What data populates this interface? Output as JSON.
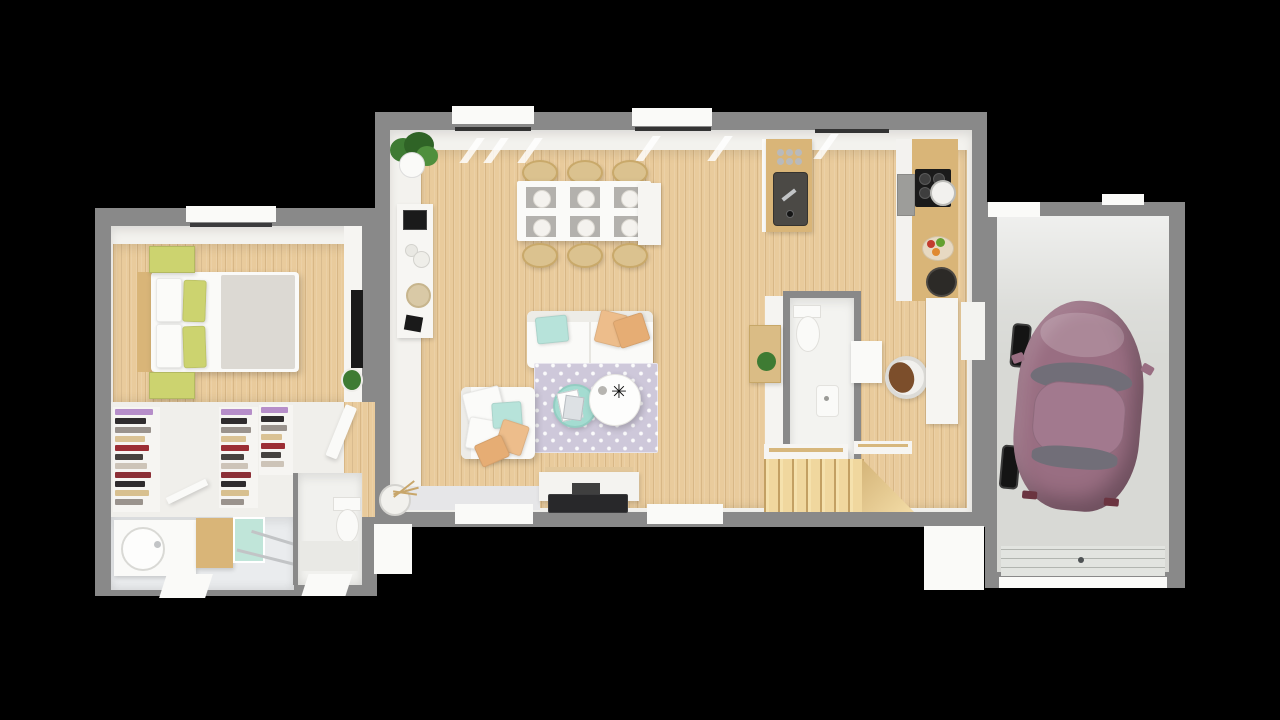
{
  "scene": {
    "description": "Top-down 3D rendered floor plan of a single-storey house with attached garage, shown on a black background",
    "view": "top-down 3D render",
    "rooms": [
      {
        "name": "bedroom",
        "floor": "light wood",
        "contents": [
          "double bed with white duvet and grey blanket",
          "white and green pillows",
          "two green nightstands",
          "wall-mounted TV",
          "window"
        ]
      },
      {
        "name": "dressing-area",
        "floor": "white",
        "contents": [
          "three open wardrobe racks with folded clothes"
        ]
      },
      {
        "name": "bathroom",
        "floor": "light grey",
        "contents": [
          "washbasin unit",
          "wood cabinet",
          "glass shower with teal panel",
          "window"
        ]
      },
      {
        "name": "wc-left",
        "contents": [
          "toilet",
          "bench",
          "window"
        ]
      },
      {
        "name": "living-dining-kitchen",
        "floor": "light wood",
        "contents": [
          "dining table with six chairs and six place settings",
          "wall shelf with decor",
          "potted plant",
          "white sofa",
          "loveseat with pillows",
          "lavender trellis rug",
          "round coffee table",
          "mint side table with magazines",
          "TV sideboard",
          "kitchen island with dark sink",
          "wall counter with cooktop and oven",
          "fruit bowl",
          "dark pot",
          "vase with branches"
        ]
      },
      {
        "name": "wc-center",
        "contents": [
          "toilet",
          "wall basin",
          "wooden crate shelf with plant"
        ]
      },
      {
        "name": "entry-hall",
        "contents": [
          "console table",
          "round chair with brown coat",
          "white sideboard",
          "door to garage"
        ]
      },
      {
        "name": "staircase",
        "material": "wood"
      },
      {
        "name": "garage",
        "floor": "concrete",
        "contents": [
          "plum hatchback car",
          "sectional garage door",
          "side door"
        ]
      }
    ]
  },
  "palette": {
    "background": "#000000",
    "wall": "#898989",
    "inner": "#f3f2ee",
    "white": "#fafaf8",
    "wood_floor": "#e9cb9c",
    "wood_furniture": "#d9b578",
    "stairs": "#f0d79e",
    "bath_floor": "#eaecee",
    "garage_floor": "#d8d9d5",
    "garage_door": "#e2e4e0",
    "car_body": "#996e82",
    "car_roof": "#a2798e",
    "car_glass": "#716e78",
    "rug": "#cec8da",
    "mint": "#b7e3da",
    "mint_dark": "#a4dcd1",
    "peach": "#edbd8b",
    "peach_dark": "#e6ad74",
    "green_accent": "#ccd36f",
    "shower_glass": "#c0e5d9",
    "plant_green": "#3e7b33",
    "dark": "#1a1a1a",
    "sink_dark": "#4b4945",
    "steel": "#c2c4c6",
    "clothes_stack": [
      "#b68ec9",
      "#2f2c2e",
      "#9a938d",
      "#dac294",
      "#9c2e35",
      "#46423f",
      "#cdc4b8",
      "#8c2f36",
      "#2f2c2e",
      "#d8c08f",
      "#9a938d",
      "#352f31"
    ]
  }
}
